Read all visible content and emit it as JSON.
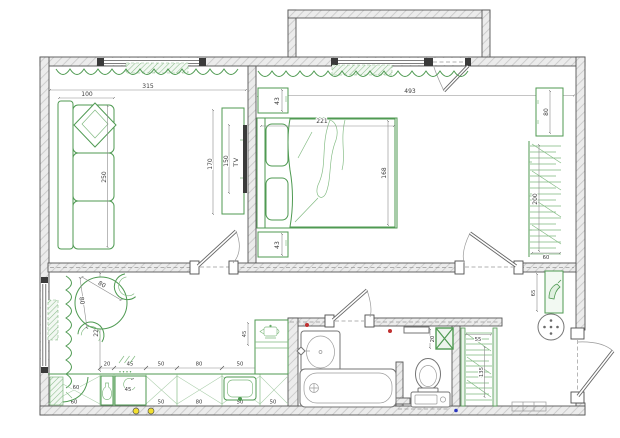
{
  "colors": {
    "wall_fill": "#ececec",
    "wall_stroke": "#565656",
    "furniture_green": "#4f9a52",
    "curtain_green": "#6fae6f",
    "fixture_gray": "#757575",
    "dot_red": "#c03030",
    "dot_yellow": "#f2df2e",
    "dot_blue": "#2b35c0"
  },
  "icons": [
    "tv-icon",
    "kettle-icon",
    "bottle-icon",
    "shoe-icon",
    "vent-x-icon",
    "faucet-icon",
    "plant-dots"
  ],
  "living_room": {
    "room_width": "315",
    "sofa_depth": "100",
    "sofa_length": "250",
    "tv_zone_height": "170",
    "tv_width": "150",
    "tv_label": "TV"
  },
  "bedroom": {
    "room_width": "493",
    "nightstand_top": "43",
    "nightstand_bottom": "43",
    "bed_width": "221",
    "bed_depth": "168",
    "dresser_length": "80",
    "wardrobe_length": "200",
    "wardrobe_depth": "60"
  },
  "kitchen": {
    "wall_length": "222",
    "table_diameter": "80",
    "table_clearance": "80",
    "corner_unit": "60",
    "oven_label": "45",
    "side_counter_depth": "45",
    "top_dims": [
      "20",
      "45",
      "50",
      "80",
      "50"
    ],
    "bottom_dims": [
      "60",
      "45",
      "50",
      "80",
      "50",
      "50"
    ]
  },
  "wc": {
    "shelf_depth": "20"
  },
  "hallway": {
    "shoe_shelf_length": "65",
    "closet_width": "55",
    "closet_length": "135"
  }
}
